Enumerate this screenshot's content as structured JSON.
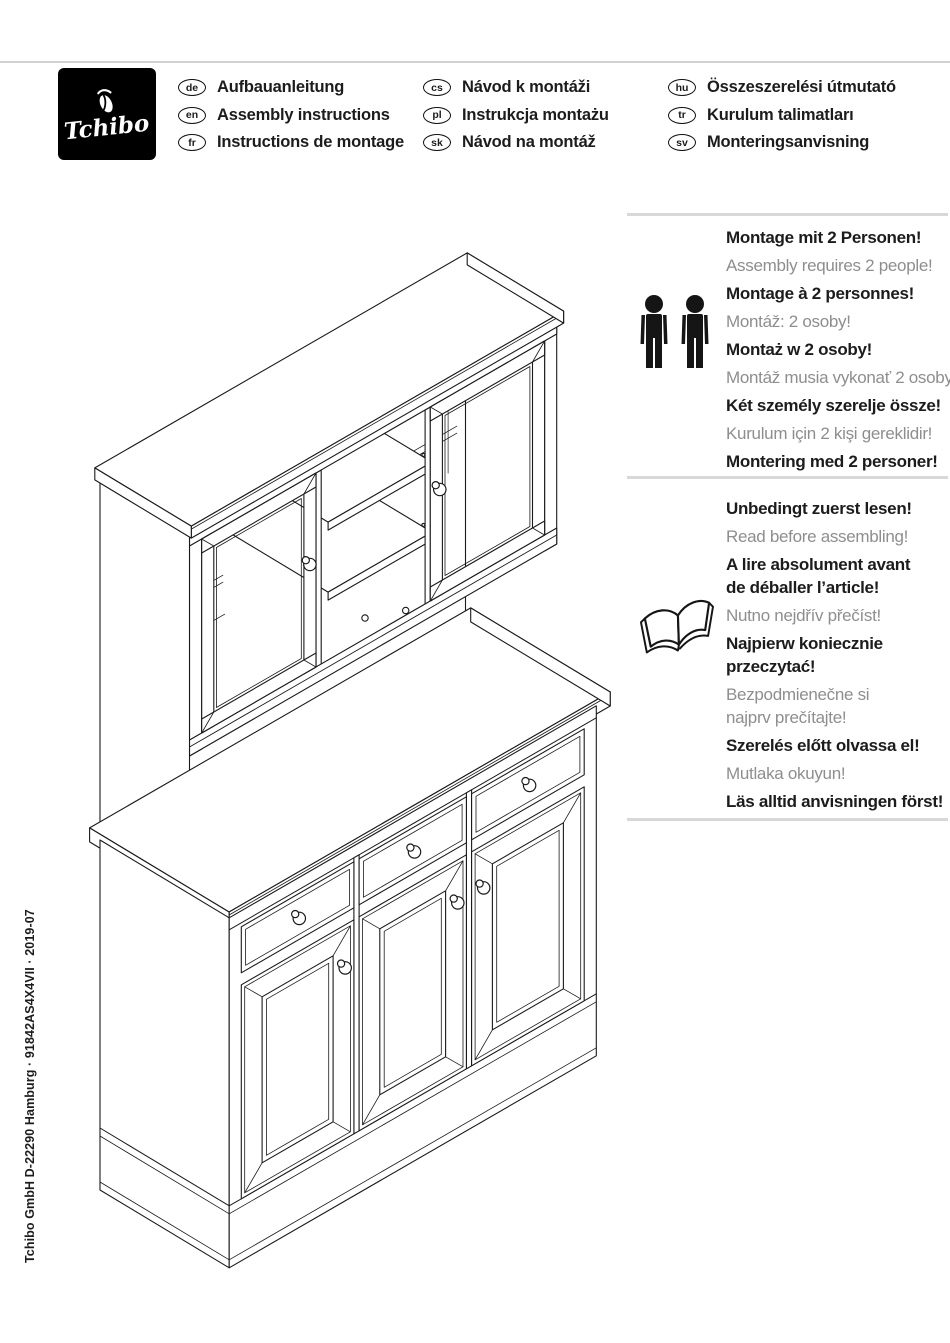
{
  "colors": {
    "ink": "#1c1c1c",
    "muted_text": "#8e8e8e",
    "rule": "#d8d8d8",
    "logo_background": "#000000",
    "line_art": "#1a1a1a"
  },
  "logo": {
    "brand": "Tchibo",
    "emblem_icon": "tchibo-emblem-icon"
  },
  "language_header": {
    "columns": [
      {
        "items": [
          {
            "code": "de",
            "label": "Aufbauanleitung"
          },
          {
            "code": "en",
            "label": "Assembly instructions"
          },
          {
            "code": "fr",
            "label": "Instructions de montage"
          }
        ]
      },
      {
        "items": [
          {
            "code": "cs",
            "label": "Návod k montáži"
          },
          {
            "code": "pl",
            "label": "Instrukcja montażu"
          },
          {
            "code": "sk",
            "label": "Návod na montáž"
          }
        ]
      },
      {
        "items": [
          {
            "code": "hu",
            "label": "Összeszerelési útmutató"
          },
          {
            "code": "tr",
            "label": "Kurulum talimatları"
          },
          {
            "code": "sv",
            "label": "Monteringsanvisning"
          }
        ]
      }
    ]
  },
  "notices": [
    {
      "icon": "two-people-icon",
      "lines": [
        {
          "text": "Montage mit 2 Personen!",
          "tone": "dark"
        },
        {
          "text": "Assembly requires 2 people!",
          "tone": "muted"
        },
        {
          "text": "Montage à 2 personnes!",
          "tone": "dark"
        },
        {
          "text": "Montáž: 2 osoby!",
          "tone": "muted"
        },
        {
          "text": "Montaż w 2 osoby!",
          "tone": "dark"
        },
        {
          "text": "Montáž musia vykonať 2 osoby!",
          "tone": "muted"
        },
        {
          "text": "Két személy szerelje össze!",
          "tone": "dark"
        },
        {
          "text": "Kurulum için 2 kişi gereklidir!",
          "tone": "muted"
        },
        {
          "text": "Montering med 2 personer!",
          "tone": "dark"
        }
      ]
    },
    {
      "icon": "open-book-icon",
      "lines": [
        {
          "text": "Unbedingt zuerst lesen!",
          "tone": "dark"
        },
        {
          "text": "Read before assembling!",
          "tone": "muted"
        },
        {
          "text": "A lire absolument avant\nde déballer l’article!",
          "tone": "dark"
        },
        {
          "text": "Nutno nejdřív přečíst!",
          "tone": "muted"
        },
        {
          "text": "Najpierw koniecznie\nprzeczytać!",
          "tone": "dark"
        },
        {
          "text": "Bezpodmienečne si\nnajprv prečítajte!",
          "tone": "muted"
        },
        {
          "text": "Szerelés előtt olvassa el!",
          "tone": "dark"
        },
        {
          "text": "Mutlaka okuyun!",
          "tone": "muted"
        },
        {
          "text": "Läs alltid anvisningen först!",
          "tone": "dark"
        }
      ]
    }
  ],
  "illustration": {
    "icon": "cabinet-line-drawing"
  },
  "imprint": "Tchibo GmbH D-22290 Hamburg · 91842AS4X4VII · 2019-07"
}
